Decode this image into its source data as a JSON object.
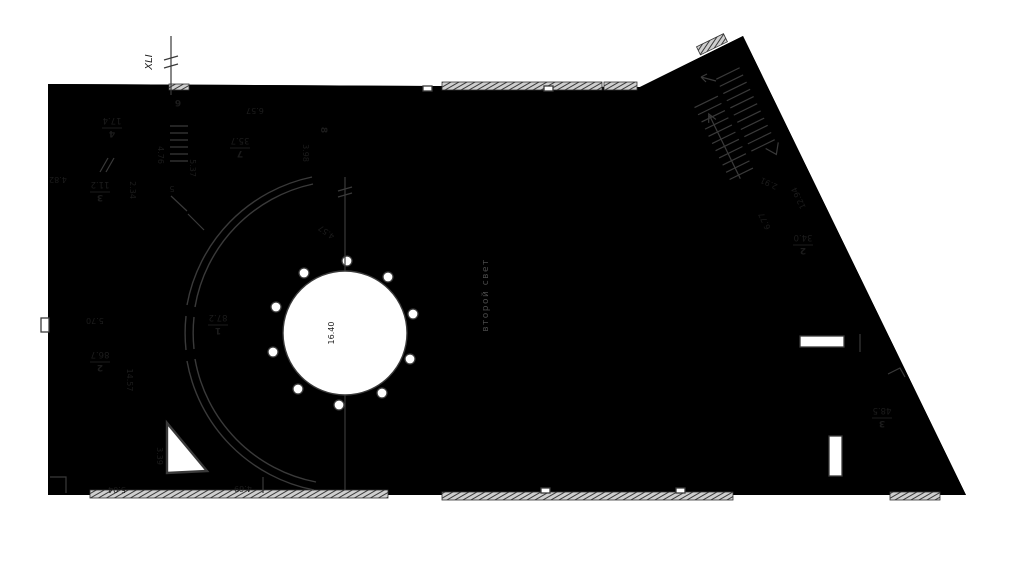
{
  "drawing": {
    "axis_label": "XLI",
    "note": "второй свет",
    "colors": {
      "highlight": "#f8f600",
      "line": "#3a3a3a"
    },
    "rooms": [
      {
        "number": "4",
        "area": "17.4"
      },
      {
        "number": "3",
        "area": "11.2"
      },
      {
        "number": "6",
        "area": ""
      },
      {
        "number": "7",
        "area": "35.7"
      },
      {
        "number": "8",
        "area": ""
      },
      {
        "number": "2",
        "area": "86.7"
      },
      {
        "number": "1",
        "area": "87.2"
      },
      {
        "number": "2",
        "area": "34.0"
      },
      {
        "number": "3",
        "area": "48.5"
      }
    ],
    "dimensions": {
      "d482": "4.82",
      "d234": "2.34",
      "d476": "4.76",
      "d5": "5",
      "d537": "5.37",
      "d657": "6.57",
      "d398": "3.98",
      "d570": "5.70",
      "d1457": "14.57",
      "d339": "3.39",
      "d504": "5.04",
      "d469": "4.69",
      "d457": "4.57",
      "d1640": "16.40",
      "d291": "2.91",
      "d1294": "12.94",
      "d677": "6.77"
    }
  }
}
